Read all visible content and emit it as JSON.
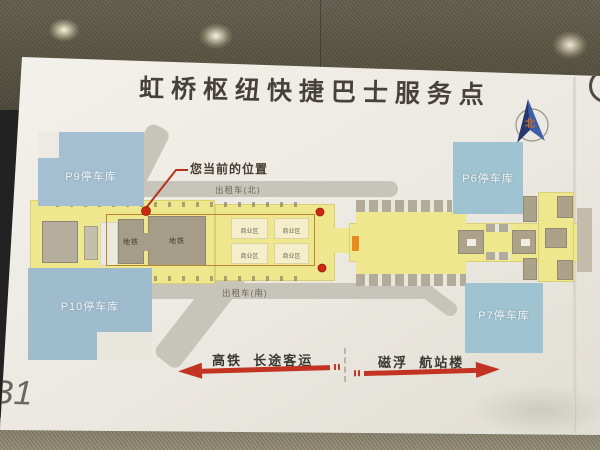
{
  "scene": {
    "floor_label": "B1"
  },
  "sign": {
    "title": "虹桥枢纽快捷巴士服务点",
    "compass_label": "北",
    "current_location_label": "您当前的位置",
    "parking": [
      {
        "label": "P9停车库"
      },
      {
        "label": "P10停车库"
      },
      {
        "label": "P6停车库"
      },
      {
        "label": "P7停车库"
      }
    ],
    "roads": {
      "taxi_north": "出租车(北)",
      "taxi_south": "出租车(南)"
    },
    "buildings": {
      "metro_1": "地铁",
      "metro_2": "地铁",
      "commercial_1": "商业区",
      "commercial_2": "商业区",
      "commercial_3": "商业区",
      "commercial_4": "商业区"
    },
    "legend": {
      "left_label": "高铁  长途客运",
      "right_label": "磁浮  航站楼"
    },
    "colors": {
      "concourse_yellow": "#efe78d",
      "parking_blue": "#a3bfd1",
      "marker_red": "#cf2812",
      "arrow_red": "#c23322",
      "service_point_orange": "#e88a1c"
    }
  }
}
